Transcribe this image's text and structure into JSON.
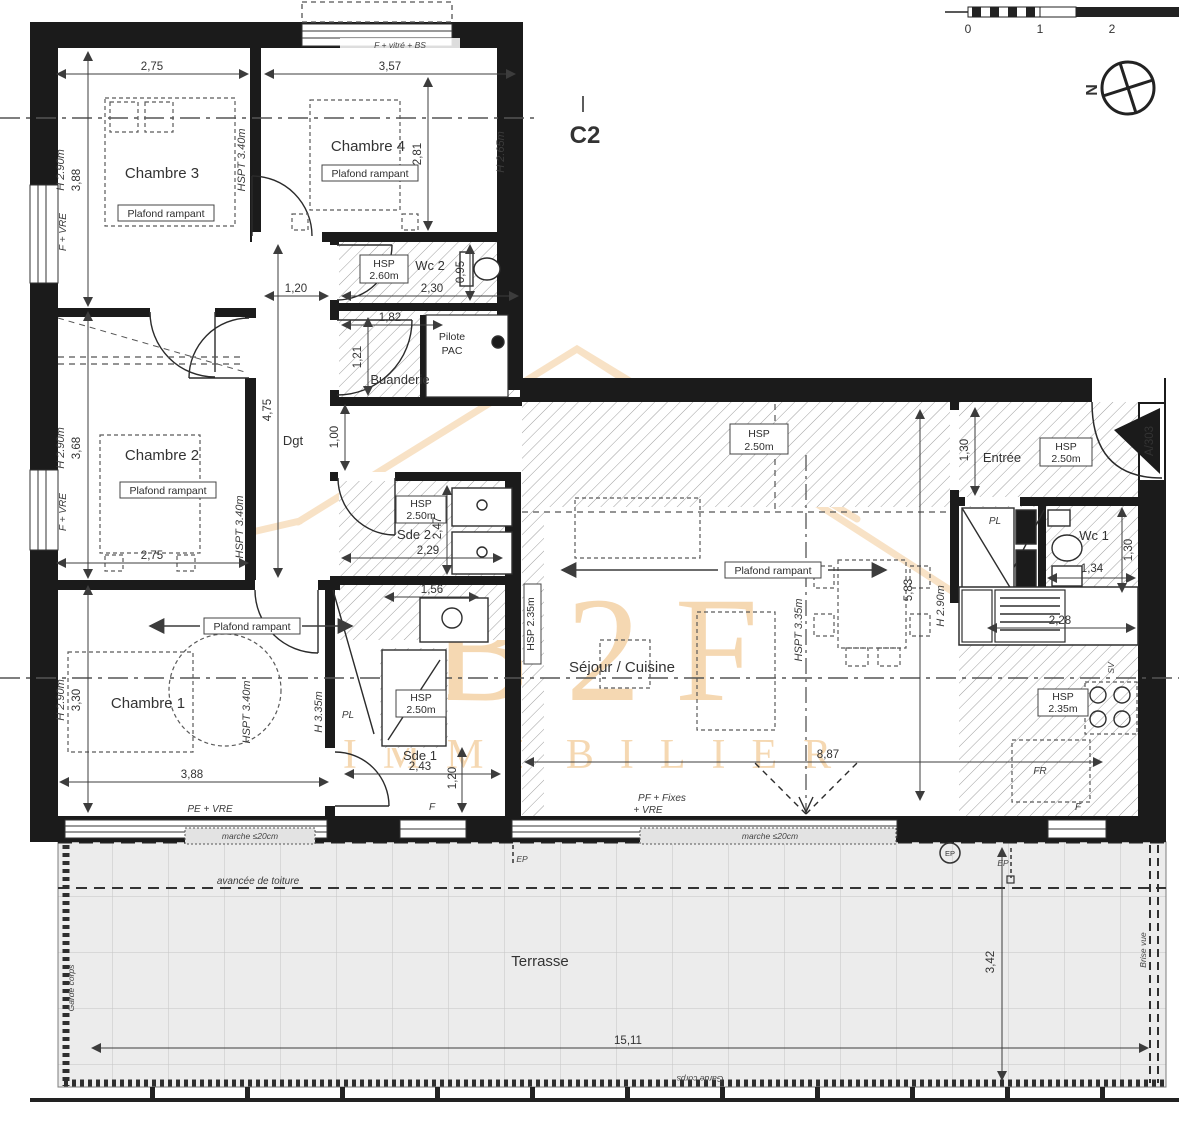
{
  "unit_label": "C2",
  "scale_bar": {
    "t0": "0",
    "t1": "1",
    "t2": "2"
  },
  "north_label": "N",
  "watermark": {
    "line1": "B2F",
    "line2": "IMMOBILIER"
  },
  "rooms": {
    "chambre3": {
      "name": "Chambre 3",
      "ceiling": "Plafond rampant",
      "width": "2,75",
      "depth": "3,88",
      "height": "H 2.90m",
      "hspt": "HSPT 3.40m",
      "window": "F + VRE"
    },
    "chambre4": {
      "name": "Chambre 4",
      "ceiling": "Plafond rampant",
      "width": "3,57",
      "depth": "2,81",
      "height": "H 2.65m",
      "window": "F + vitré + BS"
    },
    "wc2": {
      "name": "Wc 2",
      "hsp1": "HSP",
      "hsp2": "2.60m",
      "width": "2,30",
      "depth": "0,95"
    },
    "dgt": {
      "name": "Dgt",
      "length": "4,75",
      "width": "1,20",
      "width2": "1,00"
    },
    "buanderie": {
      "name": "Buanderie",
      "width": "1,82",
      "depth": "1,21",
      "pac1": "Pilote",
      "pac2": "PAC"
    },
    "chambre2": {
      "name": "Chambre 2",
      "ceiling": "Plafond rampant",
      "width": "2,75",
      "depth": "3,68",
      "height": "H 2.90m",
      "hspt": "HSPT 3.40m",
      "window": "F + VRE"
    },
    "chambre1": {
      "name": "Chambre 1",
      "ceiling": "Plafond rampant",
      "width": "3,88",
      "depth": "3,30",
      "height": "H 2.90m",
      "hspt": "HSPT 3.40m",
      "h_mid": "H 3.35m",
      "bay": "PE + VRE",
      "closet": "PL"
    },
    "sde1": {
      "name": "Sde 1",
      "hsp1": "HSP",
      "hsp2": "2.50m",
      "w_top": "1,56",
      "width": "2,43",
      "depth": "1,20",
      "window": "F"
    },
    "sde2": {
      "name": "Sde 2",
      "hsp1": "HSP",
      "hsp2": "2.50m",
      "width": "2,29",
      "depth": "2,47"
    },
    "sejour": {
      "name": "Séjour / Cuisine",
      "hsp1": "HSP",
      "hsp2": "2.50m",
      "ceiling": "Plafond rampant",
      "ridge": "HSPT 3.35m",
      "hsp_low": "HSP 2.35m",
      "k1": "HSP",
      "k2": "2.35m",
      "width": "8,87",
      "depth": "5,83",
      "height": "H 2.90m",
      "sink": "2,28",
      "fridge": "FR",
      "window": "F",
      "bay1": "PF + Fixes",
      "bay2": "+ VRE",
      "vent": "SV",
      "step": "marche ≤20cm"
    },
    "entree": {
      "name": "Entrée",
      "hsp1": "HSP",
      "hsp2": "2.50m",
      "depth": "1,30",
      "door_ref": "A/303",
      "closet": "PL"
    },
    "wc1": {
      "name": "Wc 1",
      "width": "1,34",
      "depth": "1,30"
    },
    "terrasse": {
      "name": "Terrasse",
      "width": "15,11",
      "depth": "3,42",
      "roof": "avancée de toiture",
      "guard": "Garde corps",
      "screen": "Brise vue",
      "drain": "EP"
    }
  }
}
